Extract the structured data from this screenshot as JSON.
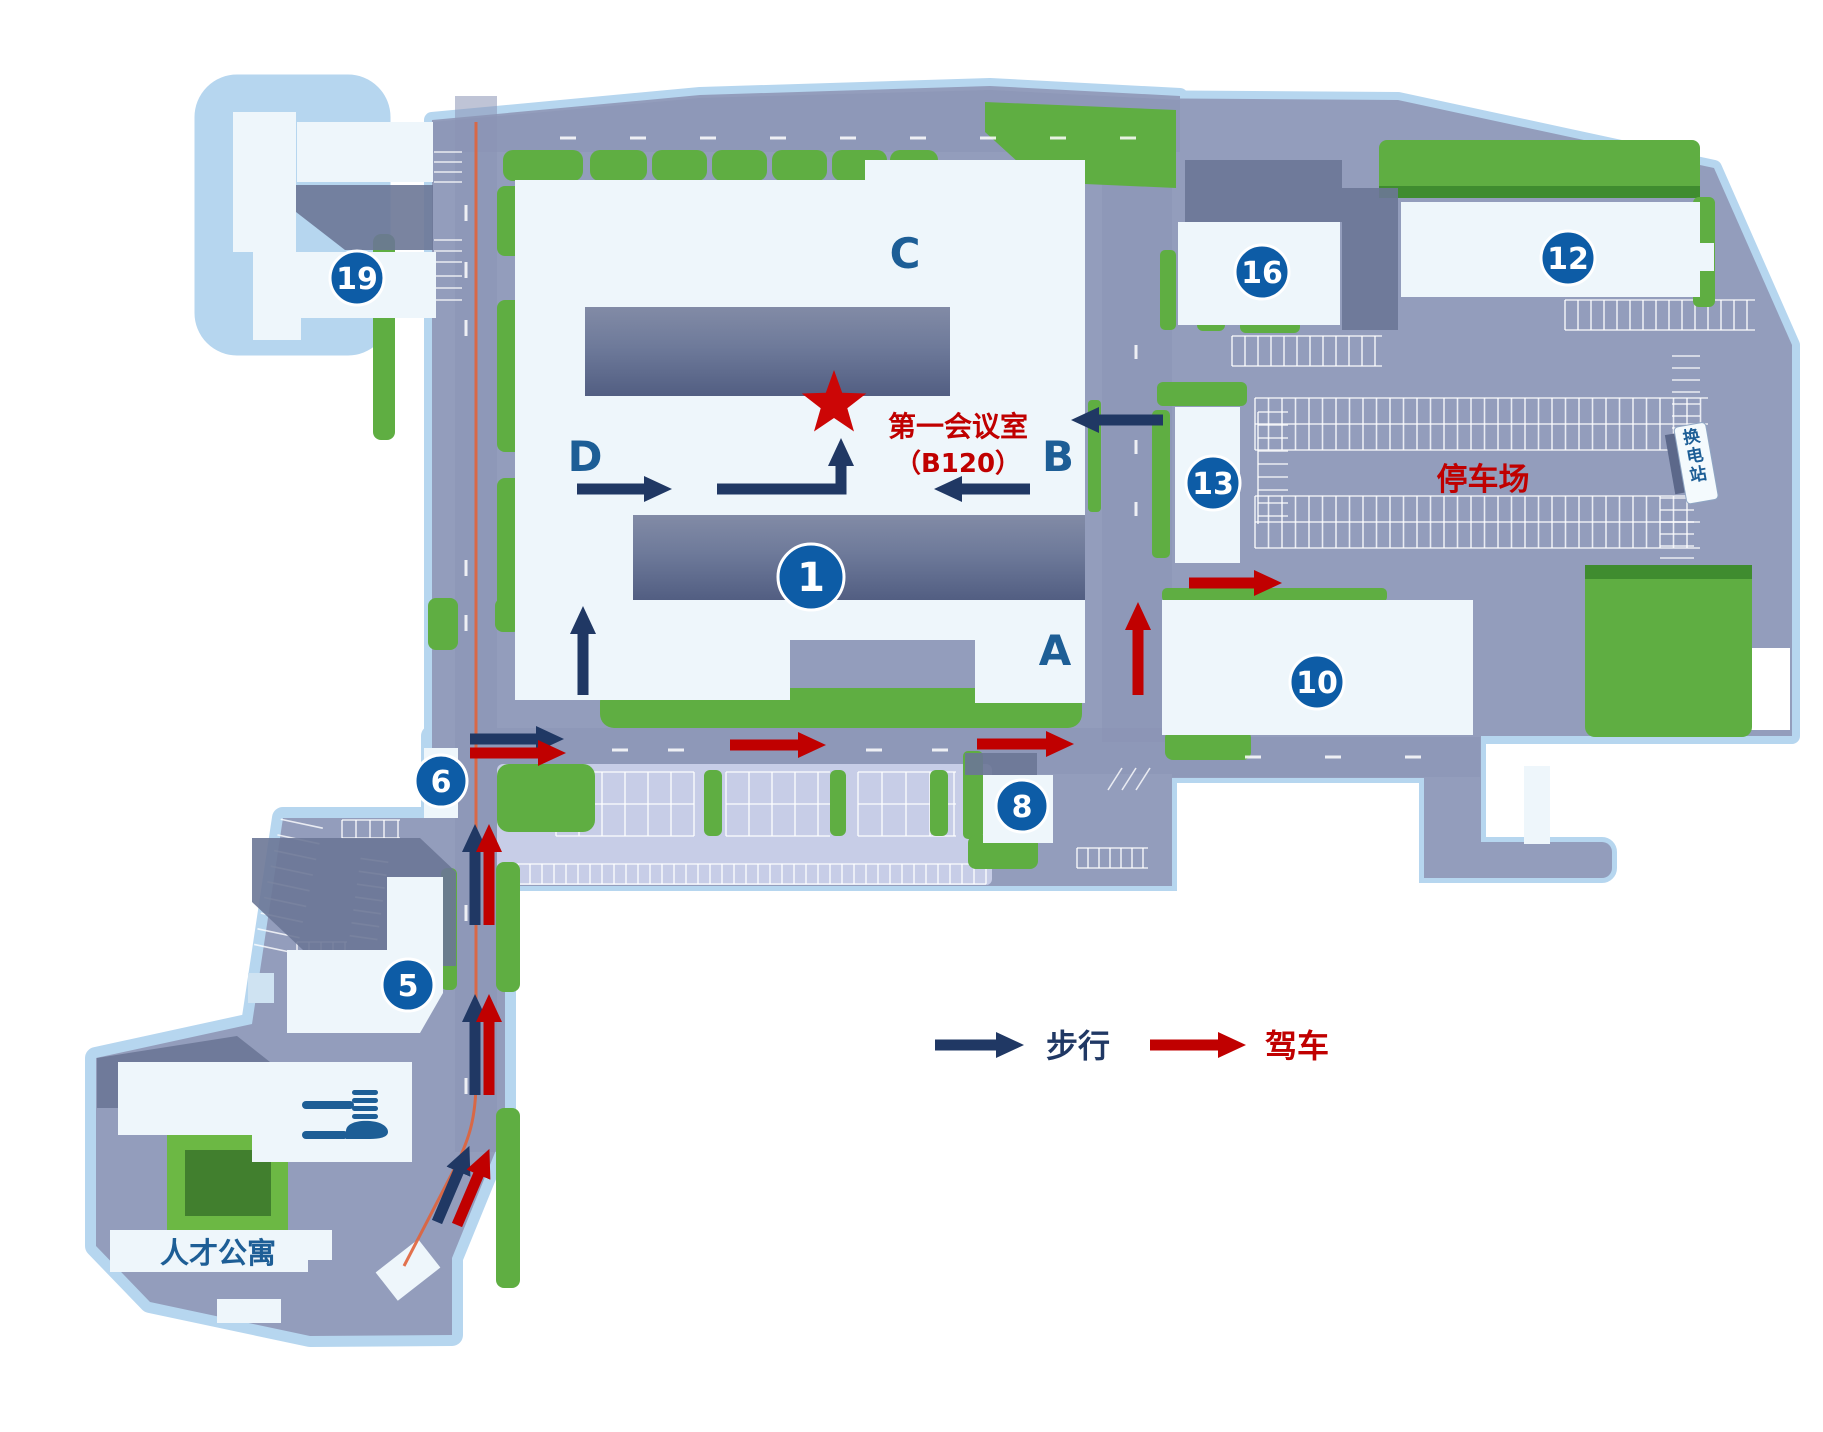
{
  "map": {
    "badges": {
      "b1": "1",
      "b5": "5",
      "b6": "6",
      "b8": "8",
      "b10": "10",
      "b12": "12",
      "b13": "13",
      "b16": "16",
      "b19": "19"
    },
    "wings": {
      "a": "A",
      "b": "B",
      "c": "C",
      "d": "D"
    },
    "labels": {
      "meeting_room": "第一会议室",
      "meeting_room_code": "（B120）",
      "parking_lot": "停车场",
      "battery_swap_station": "换电站",
      "talent_apartment": "人才公寓"
    },
    "legend": {
      "walk": "步行",
      "drive": "驾车"
    },
    "icons": {
      "destination": "star-icon",
      "restaurant": "fork-knife-icon",
      "walk_route": "walk-arrow-icon",
      "drive_route": "drive-arrow-icon"
    },
    "colors": {
      "walk_route": "#203864",
      "drive_route": "#c00000",
      "badge_blue": "#0d5ca6",
      "building_label_blue": "#1d5e96",
      "highlight_red": "#c00000",
      "green": "#5fae42",
      "ground": "#939dbc",
      "route_trace": "#e0633a"
    }
  }
}
